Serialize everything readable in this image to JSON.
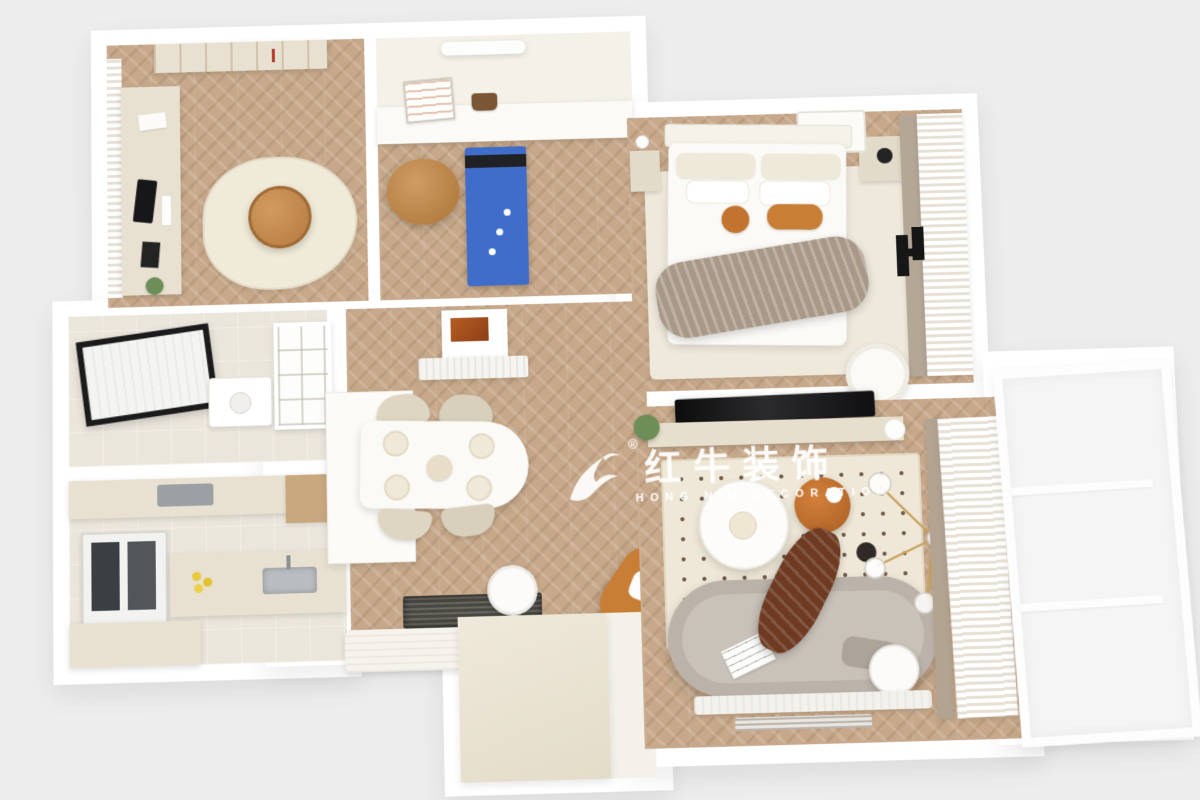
{
  "watermark": {
    "logo_icon": "bull-swoosh",
    "registered": "®",
    "title": "红牛装饰",
    "subtitle": "HONG NIU DECORATION",
    "color": "rgba(255,255,255,0.92)"
  },
  "palette": {
    "background": "#ecedec",
    "wall_white": "#ffffff",
    "wood_floor": "#c7a88a",
    "cream_cabinet": "#e8e1d1",
    "rug_cream": "#efe8d8",
    "caramel_leather": "#c28a52",
    "orange_cushion": "#c87e35",
    "treadmill_blue": "#3f6dc9",
    "tv_black": "#151515",
    "sofa_grey": "#bbb3aa",
    "chocolate_throw": "#6e3a22",
    "taupe_blanket": "#a89887",
    "amber_table": "#c2732f",
    "lemon_yellow": "#e8c93e",
    "gold_chandelier": "#c9a25e",
    "plant_green": "#6d8f57",
    "skylight_brown": "#a34f1f"
  },
  "rooms": [
    {
      "id": "study"
    },
    {
      "id": "multipurpose-room"
    },
    {
      "id": "bedroom"
    },
    {
      "id": "bathroom"
    },
    {
      "id": "kitchen"
    },
    {
      "id": "dining-area"
    },
    {
      "id": "entry-hall"
    },
    {
      "id": "living-room"
    },
    {
      "id": "balcony"
    }
  ]
}
